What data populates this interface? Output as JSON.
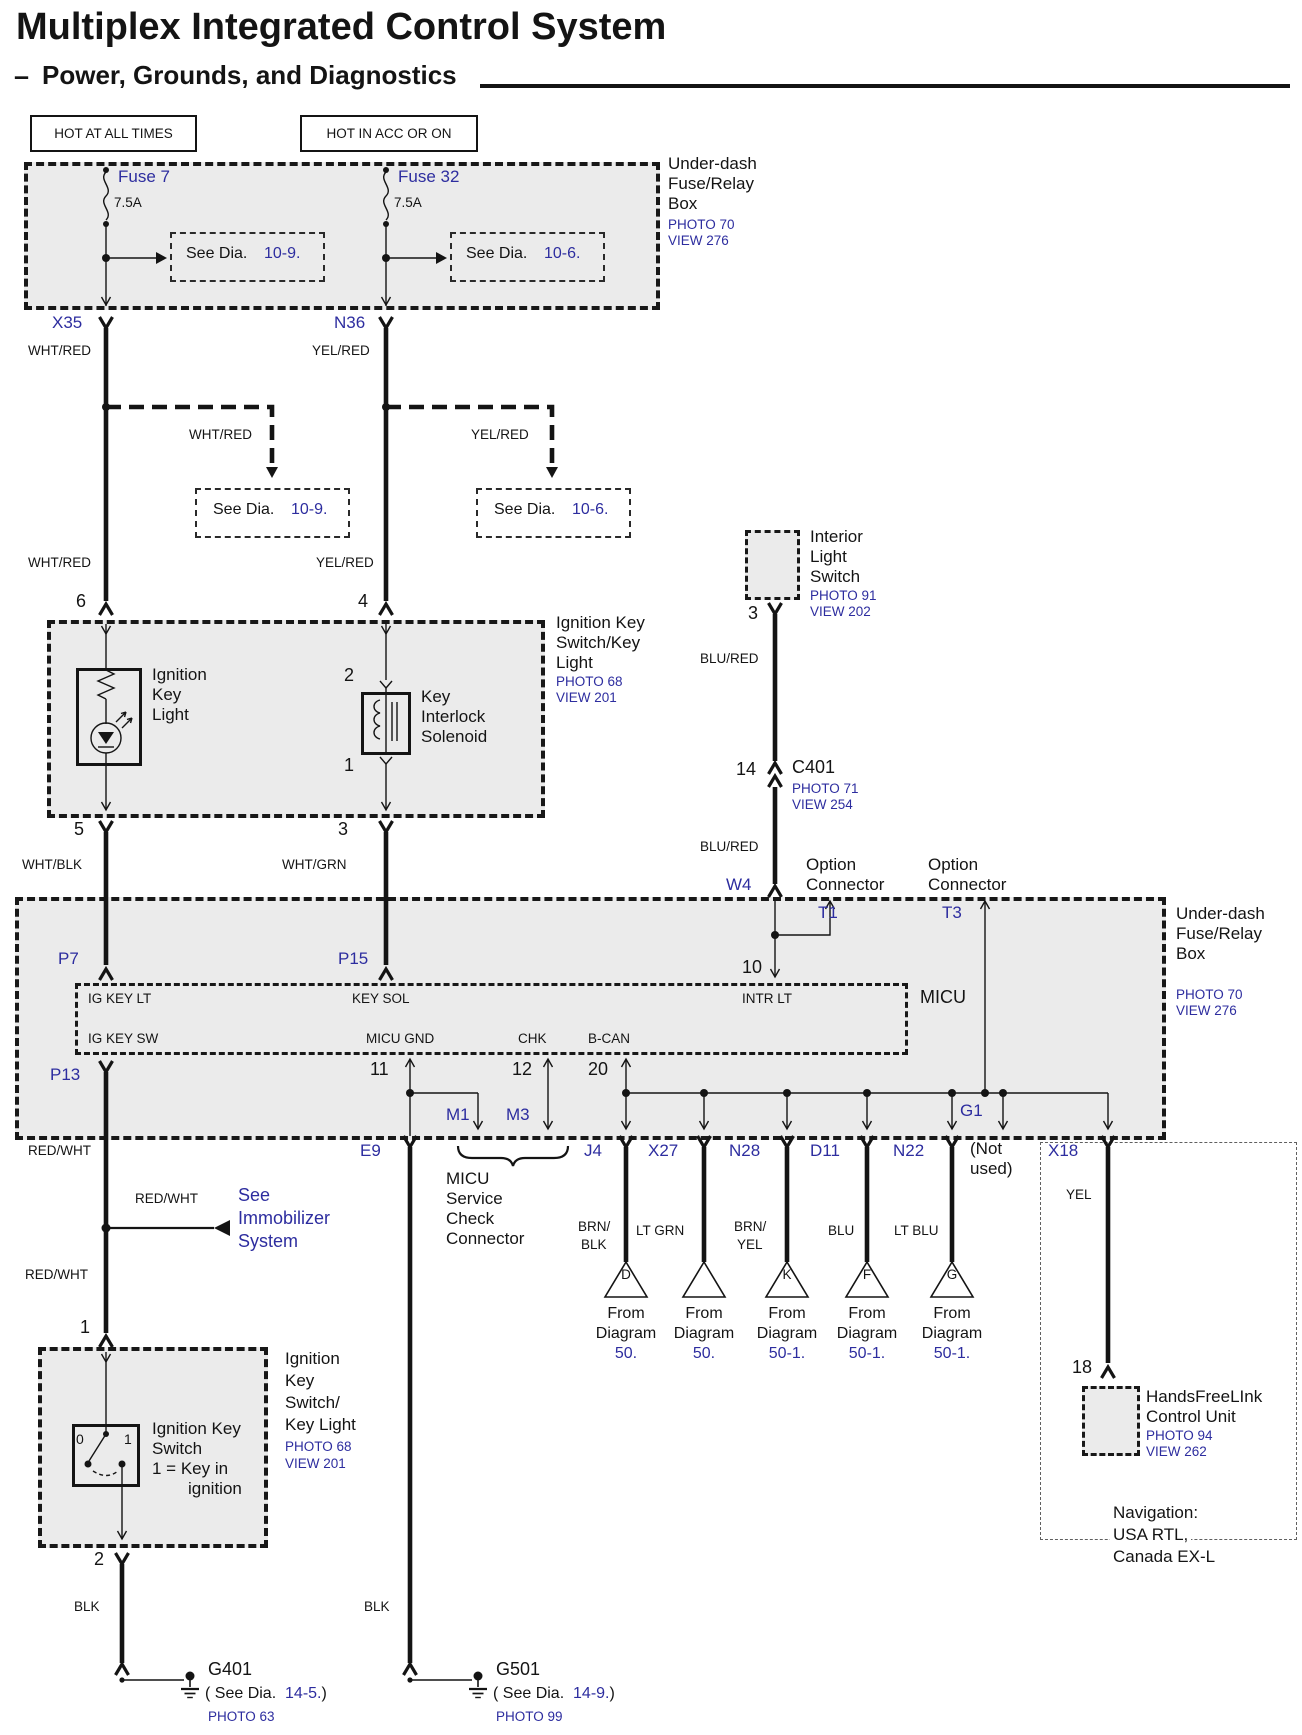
{
  "header": {
    "title": "Multiplex Integrated Control System",
    "dash": "–",
    "subtitle": "Power, Grounds, and Diagnostics"
  },
  "power_tags": {
    "hot_all": "HOT AT ALL TIMES",
    "hot_acc": "HOT IN ACC OR ON"
  },
  "see_dia": {
    "pre": "See Dia.",
    "d109": "10-9.",
    "d106": "10-6."
  },
  "fusebox_top": {
    "name_l1": "Under-dash",
    "name_l2": "Fuse/Relay",
    "name_l3": "Box",
    "photo": "PHOTO 70",
    "view": "VIEW 276",
    "fuse7": {
      "name": "Fuse 7",
      "amp": "7.5A"
    },
    "fuse32": {
      "name": "Fuse 32",
      "amp": "7.5A"
    }
  },
  "wires": {
    "wht_red": "WHT/RED",
    "yel_red": "YEL/RED",
    "wht_blk": "WHT/BLK",
    "wht_grn": "WHT/GRN",
    "blu_red": "BLU/RED",
    "red_wht": "RED/WHT",
    "brn": "BRN/",
    "blk": "BLK",
    "lt_grn": "LT GRN",
    "yel": "YEL",
    "blu": "BLU",
    "lt_blu": "LT BLU"
  },
  "pins": {
    "p1": "1",
    "p2": "2",
    "p3": "3",
    "p4": "4",
    "p5": "5",
    "p6": "6",
    "p10": "10",
    "p11": "11",
    "p12": "12",
    "p14": "14",
    "p18": "18",
    "p20": "20"
  },
  "connectors": {
    "x35": "X35",
    "n36": "N36",
    "p7": "P7",
    "p15": "P15",
    "p13": "P13",
    "w4": "W4",
    "t1": "T1",
    "t3": "T3",
    "e9": "E9",
    "m1": "M1",
    "m3": "M3",
    "j4": "J4",
    "x27": "X27",
    "n28": "N28",
    "d11": "D11",
    "n22": "N22",
    "g1": "G1",
    "x18": "X18"
  },
  "ign_upper": {
    "name_l1": "Ignition Key",
    "name_l2": "Switch/Key",
    "name_l3": "Light",
    "photo": "PHOTO 68",
    "view": "VIEW 201",
    "light_l1": "Ignition",
    "light_l2": "Key",
    "light_l3": "Light",
    "sol_l1": "Key",
    "sol_l2": "Interlock",
    "sol_l3": "Solenoid"
  },
  "interior": {
    "l1": "Interior",
    "l2": "Light",
    "l3": "Switch",
    "photo": "PHOTO 91",
    "view": "VIEW 202"
  },
  "c401": {
    "name": "C401",
    "photo": "PHOTO 71",
    "view": "VIEW 254"
  },
  "options": {
    "o1_l1": "Option",
    "o1_l2": "Connector",
    "o2_l1": "Option",
    "o2_l2": "Connector"
  },
  "bigbox": {
    "name_l1": "Under-dash",
    "name_l2": "Fuse/Relay",
    "name_l3": "Box",
    "photo": "PHOTO 70",
    "view": "VIEW 276"
  },
  "micu": {
    "name": "MICU",
    "ig_key_lt": "IG KEY LT",
    "key_sol": "KEY SOL",
    "intr_lt": "INTR LT",
    "ig_key_sw": "IG KEY SW",
    "micu_gnd": "MICU GND",
    "chk": "CHK",
    "b_can": "B-CAN"
  },
  "not_used": {
    "l1": "(Not",
    "l2": "used)"
  },
  "service": {
    "l1": "MICU",
    "l2": "Service",
    "l3": "Check",
    "l4": "Connector"
  },
  "from_diagrams": [
    {
      "letter": "D",
      "from": "From",
      "diagram": "Diagram",
      "num": "50."
    },
    {
      "letter": "",
      "from": "From",
      "diagram": "Diagram",
      "num": "50."
    },
    {
      "letter": "K",
      "from": "From",
      "diagram": "Diagram",
      "num": "50-1."
    },
    {
      "letter": "F",
      "from": "From",
      "diagram": "Diagram",
      "num": "50-1."
    },
    {
      "letter": "G",
      "from": "From",
      "diagram": "Diagram",
      "num": "50-1."
    }
  ],
  "hfl": {
    "l1": "HandsFreeLInk",
    "l2": "Control Unit",
    "photo": "PHOTO 94",
    "view": "VIEW 262"
  },
  "nav": {
    "l1": "Navigation:",
    "l2": "USA RTL,",
    "l3": "Canada EX-L"
  },
  "immobilizer": {
    "l1": "See",
    "l2": "Immobilizer",
    "l3": "System"
  },
  "ign_lower": {
    "name_l1": "Ignition",
    "name_l2": "Key",
    "name_l3": "Switch/",
    "name_l4": "Key Light",
    "photo": "PHOTO 68",
    "view": "VIEW 201",
    "sw_l1": "Ignition Key",
    "sw_l2": "Switch",
    "sw_l3": "1 =  Key in",
    "sw_l4": "ignition",
    "pos0": "0",
    "pos1": "1"
  },
  "grounds": {
    "g401": {
      "name": "G401",
      "pre": "( See Dia.",
      "num": "14-5.",
      "post": ")",
      "photo": "PHOTO 63"
    },
    "g501": {
      "name": "G501",
      "pre": "( See Dia.",
      "num": "14-9.",
      "post": ")",
      "photo": "PHOTO 99"
    }
  },
  "accent": {
    "blue": "#2d2d9f",
    "box_fill": "#ebebeb",
    "line": "#141414"
  }
}
